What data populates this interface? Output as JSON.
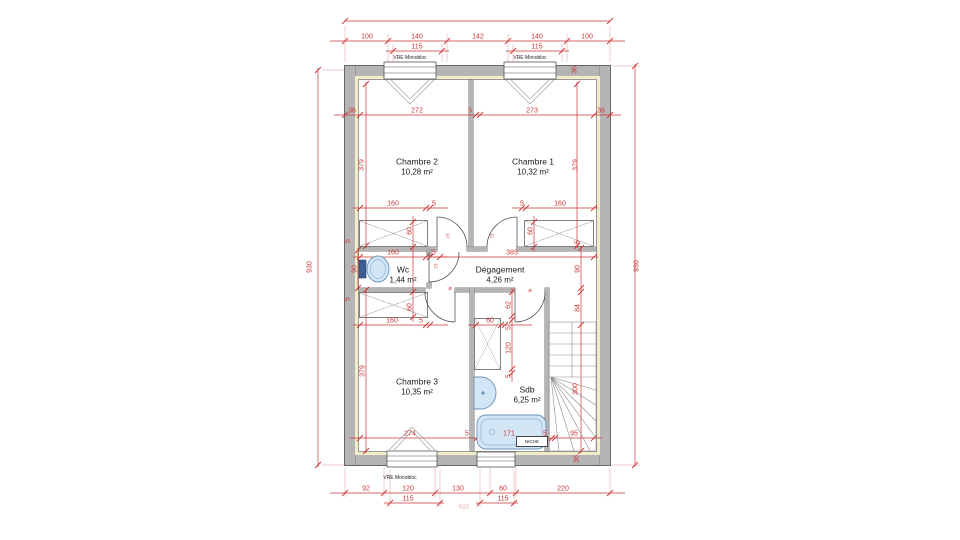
{
  "document": {
    "type": "floor-plan",
    "floor": "étage"
  },
  "colors": {
    "dimension": "#cc3434",
    "wall": "#b5b5b5",
    "insulation": "#f2edc9",
    "fixture": "#d3e6f5"
  },
  "rooms": {
    "chambre2": {
      "name": "Chambre 2",
      "area": "10,28 m²"
    },
    "chambre1": {
      "name": "Chambre 1",
      "area": "10,32 m²"
    },
    "wc": {
      "name": "Wc",
      "area": "1,44 m²"
    },
    "degagement": {
      "name": "Dégagement",
      "area": "4,26 m²"
    },
    "chambre3": {
      "name": "Chambre 3",
      "area": "10,35 m²"
    },
    "sdb": {
      "name": "Sdb",
      "area": "6,25 m²"
    }
  },
  "labels": {
    "niche": "NICHE",
    "window": "VRE Monobloc"
  },
  "overall_dimensions": {
    "width": "622",
    "height": "930"
  },
  "annotations": [
    {
      "t": "100",
      "x": 367,
      "y": 37,
      "c": "d"
    },
    {
      "t": "140",
      "x": 417,
      "y": 37,
      "c": "d"
    },
    {
      "t": "142",
      "x": 478,
      "y": 37,
      "c": "d"
    },
    {
      "t": "140",
      "x": 537,
      "y": 37,
      "c": "d"
    },
    {
      "t": "100",
      "x": 587,
      "y": 37,
      "c": "d"
    },
    {
      "t": "115",
      "x": 417,
      "y": 47,
      "c": "d"
    },
    {
      "t": "115",
      "x": 537,
      "y": 47,
      "c": "d"
    },
    {
      "t": "VRE Monobloc",
      "x": 410,
      "y": 58,
      "c": "w"
    },
    {
      "t": "VRE Monobloc",
      "x": 530,
      "y": 58,
      "c": "w"
    },
    {
      "t": "36",
      "x": 575,
      "y": 70,
      "c": "dv"
    },
    {
      "t": "36",
      "x": 352,
      "y": 111,
      "c": "d"
    },
    {
      "t": "272",
      "x": 417,
      "y": 111,
      "c": "d"
    },
    {
      "t": "5",
      "x": 470,
      "y": 111,
      "c": "d"
    },
    {
      "t": "273",
      "x": 532,
      "y": 111,
      "c": "d"
    },
    {
      "t": "36",
      "x": 601,
      "y": 111,
      "c": "d"
    },
    {
      "t": "379",
      "x": 362,
      "y": 165,
      "c": "dv"
    },
    {
      "t": "379",
      "x": 576,
      "y": 165,
      "c": "dv"
    },
    {
      "t": "160",
      "x": 393,
      "y": 204,
      "c": "d"
    },
    {
      "t": "5",
      "x": 434,
      "y": 204,
      "c": "d"
    },
    {
      "t": "5",
      "x": 522,
      "y": 204,
      "c": "d"
    },
    {
      "t": "160",
      "x": 560,
      "y": 204,
      "c": "d"
    },
    {
      "t": "60",
      "x": 410,
      "y": 231,
      "c": "dv"
    },
    {
      "t": "60",
      "x": 531,
      "y": 231,
      "c": "dv"
    },
    {
      "t": "5",
      "x": 348,
      "y": 241,
      "c": "dv"
    },
    {
      "t": "5",
      "x": 578,
      "y": 242,
      "c": "dv"
    },
    {
      "t": "73",
      "x": 448,
      "y": 236,
      "c": "dt"
    },
    {
      "t": "73",
      "x": 492,
      "y": 236,
      "c": "dt"
    },
    {
      "t": "160",
      "x": 393,
      "y": 253,
      "c": "d"
    },
    {
      "t": "5",
      "x": 434,
      "y": 253,
      "c": "d"
    },
    {
      "t": "385",
      "x": 512,
      "y": 253,
      "c": "d"
    },
    {
      "t": "90",
      "x": 355,
      "y": 269,
      "c": "dv"
    },
    {
      "t": "90",
      "x": 578,
      "y": 269,
      "c": "dv"
    },
    {
      "t": "73",
      "x": 436,
      "y": 266,
      "c": "dt"
    },
    {
      "t": "ø",
      "x": 450,
      "y": 289,
      "c": "dt2"
    },
    {
      "t": "ø",
      "x": 530,
      "y": 291,
      "c": "dt2"
    },
    {
      "t": "62",
      "x": 509,
      "y": 305,
      "c": "dv"
    },
    {
      "t": "84",
      "x": 578,
      "y": 308,
      "c": "dv"
    },
    {
      "t": "60",
      "x": 410,
      "y": 307,
      "c": "dv"
    },
    {
      "t": "5",
      "x": 348,
      "y": 299,
      "c": "dv"
    },
    {
      "t": "160",
      "x": 392,
      "y": 321,
      "c": "d"
    },
    {
      "t": "5",
      "x": 421,
      "y": 321,
      "c": "d"
    },
    {
      "t": "60",
      "x": 490,
      "y": 321,
      "c": "d"
    },
    {
      "t": "5",
      "x": 509,
      "y": 328,
      "c": "dv"
    },
    {
      "t": "120",
      "x": 509,
      "y": 348,
      "c": "dv"
    },
    {
      "t": "5",
      "x": 509,
      "y": 376,
      "c": "dv"
    },
    {
      "t": "379",
      "x": 363,
      "y": 371,
      "c": "dv"
    },
    {
      "t": "300",
      "x": 576,
      "y": 389,
      "c": "dv"
    },
    {
      "t": "274",
      "x": 410,
      "y": 434,
      "c": "d"
    },
    {
      "t": "5",
      "x": 467,
      "y": 434,
      "c": "d"
    },
    {
      "t": "171",
      "x": 509,
      "y": 434,
      "c": "d"
    },
    {
      "t": "5",
      "x": 545,
      "y": 434,
      "c": "d"
    },
    {
      "t": "95",
      "x": 574,
      "y": 434,
      "c": "d"
    },
    {
      "t": "36",
      "x": 577,
      "y": 459,
      "c": "dv"
    },
    {
      "t": "VRE Monobloc",
      "x": 400,
      "y": 478,
      "c": "w"
    },
    {
      "t": "92",
      "x": 366,
      "y": 489,
      "c": "d"
    },
    {
      "t": "120",
      "x": 408,
      "y": 489,
      "c": "d"
    },
    {
      "t": "130",
      "x": 458,
      "y": 489,
      "c": "d"
    },
    {
      "t": "60",
      "x": 503,
      "y": 489,
      "c": "d"
    },
    {
      "t": "220",
      "x": 563,
      "y": 489,
      "c": "d"
    },
    {
      "t": "115",
      "x": 408,
      "y": 499,
      "c": "d"
    },
    {
      "t": "115",
      "x": 503,
      "y": 499,
      "c": "d"
    },
    {
      "t": "622",
      "x": 464,
      "y": 507,
      "c": "f"
    },
    {
      "t": "930",
      "x": 310,
      "y": 267,
      "c": "dv"
    },
    {
      "t": "930",
      "x": 637,
      "y": 266,
      "c": "dv"
    }
  ]
}
